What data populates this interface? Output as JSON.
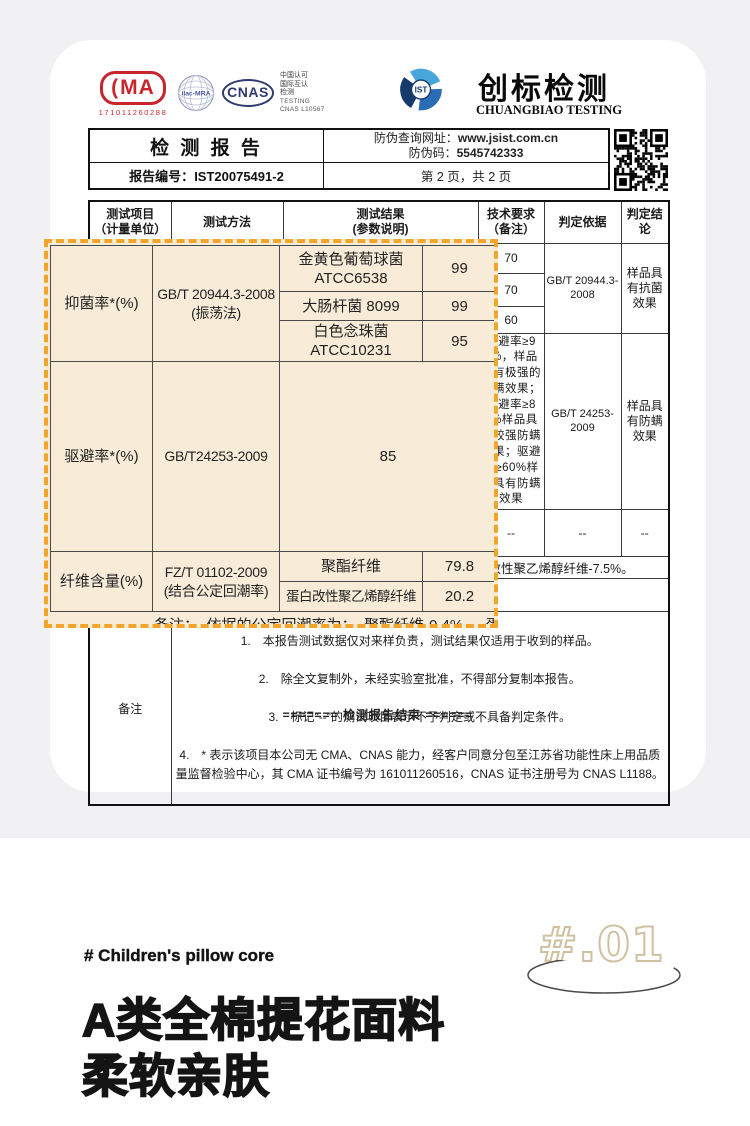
{
  "certs": {
    "cma": {
      "label": "MA",
      "number": "171011260288"
    },
    "ilac": {
      "label": "ilac-MRA"
    },
    "cnas": {
      "label": "CNAS"
    },
    "accreditation": {
      "line1": "中国认可",
      "line2": "国际互认",
      "line3": "检测",
      "line4": "TESTING",
      "line5": "CNAS L10567"
    }
  },
  "brand": {
    "ist": "IST",
    "name_cn": "创标检测",
    "name_en": "CHUANGBIAO TESTING"
  },
  "report_head": {
    "title": "检 测 报 告",
    "antifake_url_label": "防伪查询网址：",
    "antifake_url": "www.jsist.com.cn",
    "antifake_code_label": "防伪码：",
    "antifake_code": "5545742333",
    "report_no_label": "报告编号：",
    "report_no": "IST20075491-2",
    "page_info": "第 2 页，共 2 页"
  },
  "table": {
    "headers": {
      "item": "测试项目\n（计量单位）",
      "method": "测试方法",
      "result": "测试结果\n(参数说明)",
      "requirement": "技术要求\n（备注）",
      "basis": "判定依据",
      "conclusion": "判定结论"
    },
    "antibacterial": {
      "req1": "70",
      "req2": "70",
      "req3": "60",
      "basis": "GB/T 20944.3-2008",
      "conclusion": "样品具有抗菌效果"
    },
    "mite": {
      "requirement": "驱避率≥95%，样品具有极强的防螨效果；驱避率≥80%样品具有较强防螨效果；驱避率≥60%样品具有防螨效果",
      "basis": "GB/T 24253-2009",
      "conclusion": "样品具有防螨效果"
    },
    "fiber": {
      "requirement": "--",
      "basis": "--",
      "conclusion": "--"
    },
    "remark_line": "备注：依据的公定回潮率为：聚酯纤维-0.4%，蛋白改性聚乙烯醇纤维-7.5%。",
    "notes_label": "备注",
    "note1": "1.　本报告测试数据仅对来样负责，测试结果仅适用于收到的样品。",
    "note2": "2.　除全文复制外，未经实验室批准，不得部分复制本报告。",
    "note3": "3.　标记\"--\"的测试项目表示不予判定或不具备判定条件。",
    "note4": "4.　* 表示该项目本公司无 CMA、CNAS 能力，经客户同意分包至江苏省功能性床上用品质量监督检验中心，其 CMA 证书编号为 161011260516，CNAS 证书注册号为 CNAS L1188。",
    "end_line": "======= 检测报告结束 ======"
  },
  "highlight": {
    "row1": {
      "item": "抑菌率*(%)",
      "method": "GB/T 20944.3-2008\n(振荡法)",
      "param1": "金黄色葡萄球菌\nATCC6538",
      "value1": "99",
      "param2": "大肠杆菌 8099",
      "value2": "99",
      "param3": "白色念珠菌\nATCC10231",
      "value3": "95"
    },
    "row2": {
      "item": "驱避率*(%)",
      "method": "GB/T24253-2009",
      "value": "85"
    },
    "row3": {
      "item": "纤维含量(%)",
      "method": "FZ/T 01102-2009\n(结合公定回潮率)",
      "param1": "聚酯纤维",
      "value1": "79.8",
      "param2": "蛋白改性聚乙烯醇纤维",
      "value2": "20.2"
    },
    "partial_remark": "备注：　依据的公定回潮率为：　聚酯纤维-0.4%，　蛋白改性聚"
  },
  "bottom": {
    "tag": "# Children's pillow core",
    "badge": "#.01",
    "title_line1": "A类全棉提花面料",
    "title_line2": "柔软亲肤"
  },
  "colors": {
    "accent_orange": "#f2a52b",
    "highlight_bg": "#f8ecd9",
    "cma_red": "#c9252c",
    "cnas_navy": "#2e3a6e",
    "ist_blue": "#2a6db5",
    "badge_tan": "#cfc0a0"
  }
}
